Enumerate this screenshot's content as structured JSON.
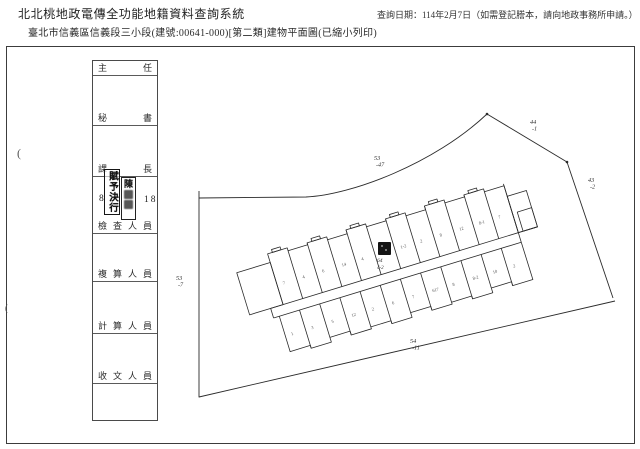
{
  "header": {
    "system_title": "北北桃地政電傳全功能地籍資料查詢系統",
    "query_date": "查詢日期：114年2月7日（如需登記謄本，請向地政事務所申請。）",
    "document_title": "臺北市信義區信義段三小段(建號:00641-000)[第二類]建物平面圖(已縮小列印)"
  },
  "signature_table": {
    "rows": [
      {
        "label": "主 任"
      },
      {
        "label": "秘 書"
      },
      {
        "label": "課 長"
      },
      {
        "label": "檢 查 人 員"
      },
      {
        "label": "複 算 人 員"
      },
      {
        "label": "計 算 人 員"
      },
      {
        "label": "收 文 人 員"
      }
    ]
  },
  "stamps": {
    "approval": "賦予決行",
    "name_first_char": "陳",
    "left_number": "8",
    "right_number": "18"
  },
  "plan": {
    "lot_labels": [
      {
        "name": "lot-53-47",
        "line1": "53",
        "line2": "-47",
        "x": 368,
        "y": 114
      },
      {
        "name": "lot-44-1",
        "line1": "44",
        "line2": "-1",
        "x": 524,
        "y": 78
      },
      {
        "name": "lot-43-2",
        "line1": "43",
        "line2": "-2",
        "x": 582,
        "y": 136
      },
      {
        "name": "lot-53-7",
        "line1": "53",
        "line2": "-7",
        "x": 170,
        "y": 234
      },
      {
        "name": "lot-54-11",
        "line1": "54",
        "line2": "-11",
        "x": 404,
        "y": 297
      }
    ],
    "highlight": {
      "label_top": "64",
      "label_bottom": "4-2"
    },
    "unit_marks_top": [
      "7",
      "4",
      "6",
      "14",
      "4",
      "3",
      "1-2",
      "2",
      "8",
      "12",
      "8-1",
      "7"
    ],
    "unit_marks_bottom": [
      "1",
      "3",
      "5",
      "12",
      "2",
      "6",
      "7",
      "617",
      "8",
      "8-2",
      "10",
      "2"
    ]
  },
  "artifact_marks": [
    {
      "text": "(",
      "x": 17,
      "y": 146,
      "size": 12
    },
    {
      "text": "(",
      "x": 5,
      "y": 303,
      "size": 9
    }
  ],
  "colors": {
    "ink": "#2b2b2b",
    "stamp_ink": "#151515"
  }
}
